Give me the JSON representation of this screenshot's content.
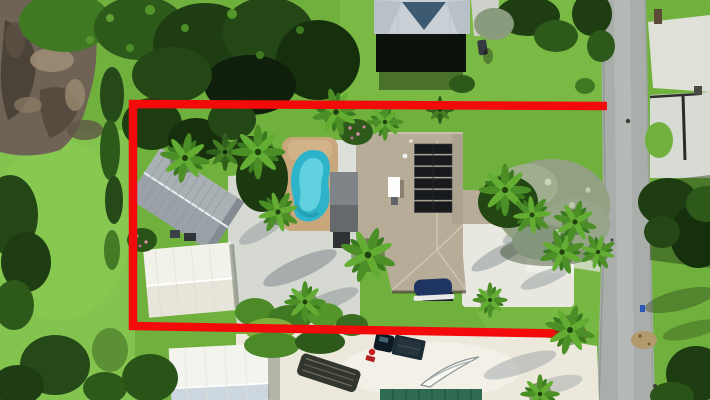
{
  "scene": {
    "type": "aerial-drone-photograph",
    "description": "Top-down aerial view of a residential lot outlined with a thick red property boundary. Inside: single-family house with tan shingle roof and rooftop solar panels, kidney-shaped swimming pool on a tan deck, gray corrugated metal shed, white shed, concrete courtyard, many palm trees and green lawn. Outside: dirt lot and dense tree canopy upper-left, neighbor house with blue-gray hip roof at top, vertical street at right with concrete driveway aprons, and a lower neighbor lot with white workshop, pickup truck, boat trailer and white boat on sand.",
    "boundary": {
      "color": "#f30b0b",
      "stroke_width": 8.5,
      "points": "607,106 133,104 133,326 586,334"
    },
    "colors": {
      "grass_base": "#6fb13c",
      "grass_light": "#82c44d",
      "canopy_dark": "#1e3d12",
      "canopy_mid": "#2d5a1a",
      "olive_tree": "#93a183",
      "dirt": "#6e6355",
      "road": "#a9aeab",
      "concrete": "#d8dbd3",
      "sand": "#ece9dc",
      "pool_deck": "#c8a77d",
      "pool_water": "#2eb4ca",
      "house_roof": "#b6ac97",
      "solar_panel": "#17191d",
      "metal_shed": "#aab1b5",
      "white_shed": "#f3f2ea",
      "neighbor_roof": "#c9d0d5",
      "neighbor_gable": "#3d5a70",
      "workshop_roof_blue": "#ccd7df",
      "teal_roof": "#2e6b52"
    },
    "objects": [
      {
        "label": "red property boundary outline"
      },
      {
        "label": "main house tan shingle roof"
      },
      {
        "label": "solar panel array (6 rows)"
      },
      {
        "label": "kidney-shaped swimming pool"
      },
      {
        "label": "tan pool deck"
      },
      {
        "label": "gray corrugated metal shed"
      },
      {
        "label": "white storage shed"
      },
      {
        "label": "concrete courtyard driveway"
      },
      {
        "label": "neighbor hip-roof house (top)"
      },
      {
        "label": "street running vertically (right)"
      },
      {
        "label": "concrete driveway aprons (right of street)"
      },
      {
        "label": "dirt lot (top-left)"
      },
      {
        "label": "dense tree canopy (top-left)"
      },
      {
        "label": "olive-gray tree cluster (right lawn)"
      },
      {
        "label": "palm trees"
      },
      {
        "label": "white workshop building (bottom)"
      },
      {
        "label": "dark pickup truck (bottom)"
      },
      {
        "label": "boat on trailer (bottom)"
      },
      {
        "label": "white boat hull on sand (bottom)"
      },
      {
        "label": "teal metal roof (bottom edge)"
      }
    ]
  }
}
